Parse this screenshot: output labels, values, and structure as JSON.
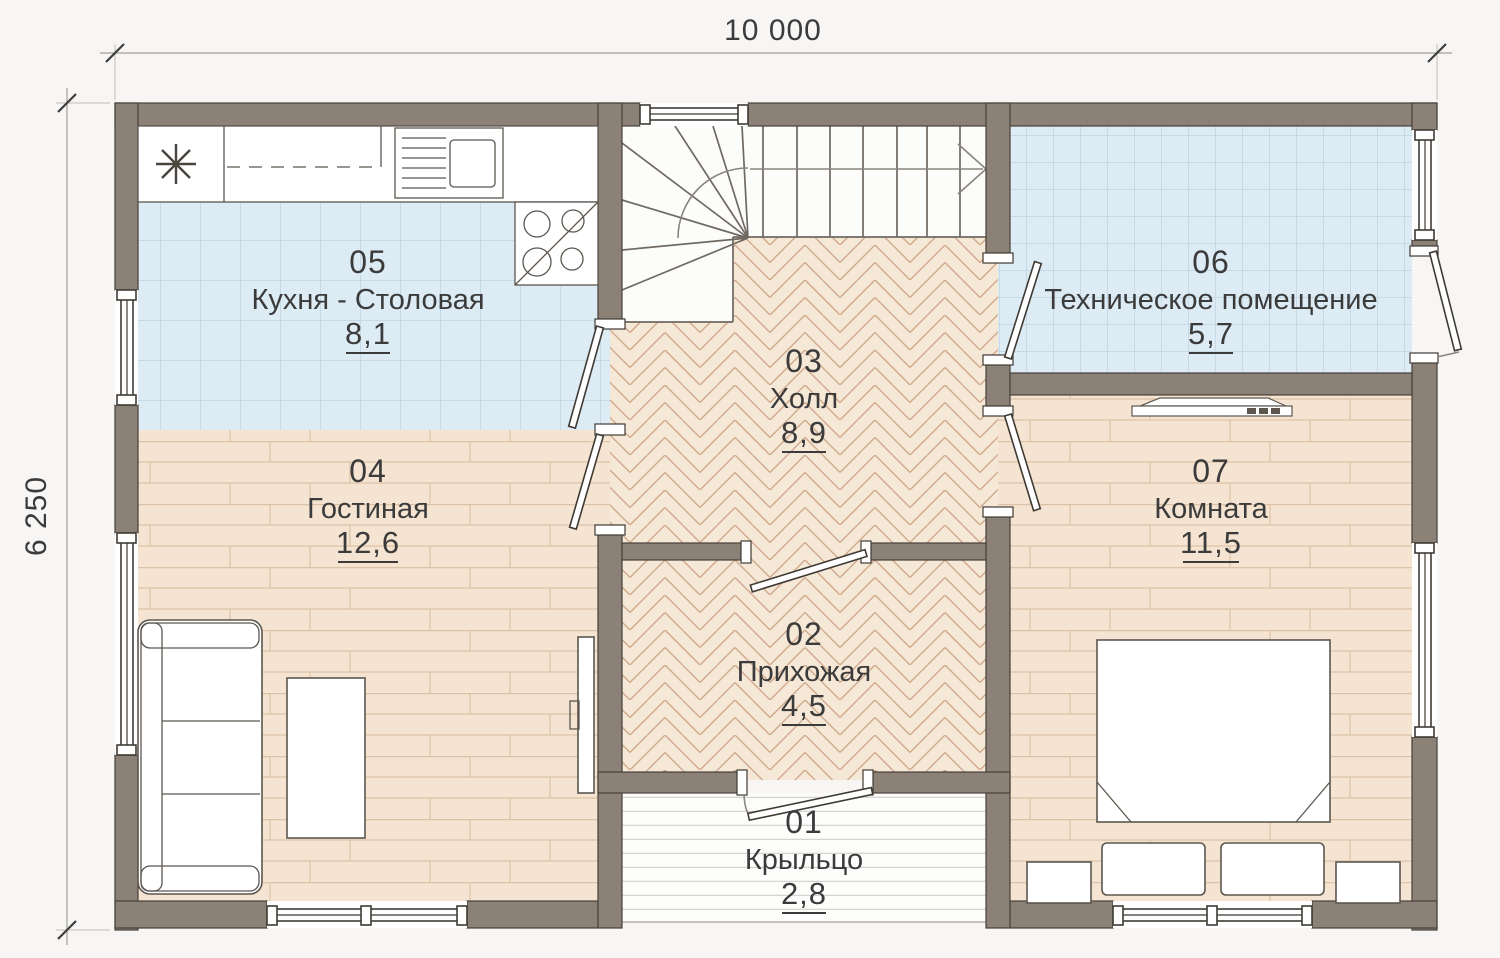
{
  "plan": {
    "dimensions": {
      "width_label": "10 000",
      "depth_label": "6 250"
    },
    "rooms": [
      {
        "number": "01",
        "name": "Крыльцо",
        "area": "2,8"
      },
      {
        "number": "02",
        "name": "Прихожая",
        "area": "4,5"
      },
      {
        "number": "03",
        "name": "Холл",
        "area": "8,9"
      },
      {
        "number": "04",
        "name": "Гостиная",
        "area": "12,6"
      },
      {
        "number": "05",
        "name": "Кухня - Столовая",
        "area": "8,1"
      },
      {
        "number": "06",
        "name": "Техническое помещение",
        "area": "5,7"
      },
      {
        "number": "07",
        "name": "Комната",
        "area": "11,5"
      }
    ],
    "palette": {
      "wall": "#8b8176",
      "tile_floor": "#dcebf4",
      "tile_grid": "#b9d0de",
      "parquet_floor": "#f6e8d7",
      "parquet_line": "#d0a98b",
      "plank_floor": "#f4e4d1",
      "plank_line": "#dcc3a8",
      "background": "#f7f6f4",
      "ink": "#3b3b3b"
    },
    "icons": [
      "appliance-asterisk-icon",
      "stair-direction-arrow-icon"
    ]
  }
}
